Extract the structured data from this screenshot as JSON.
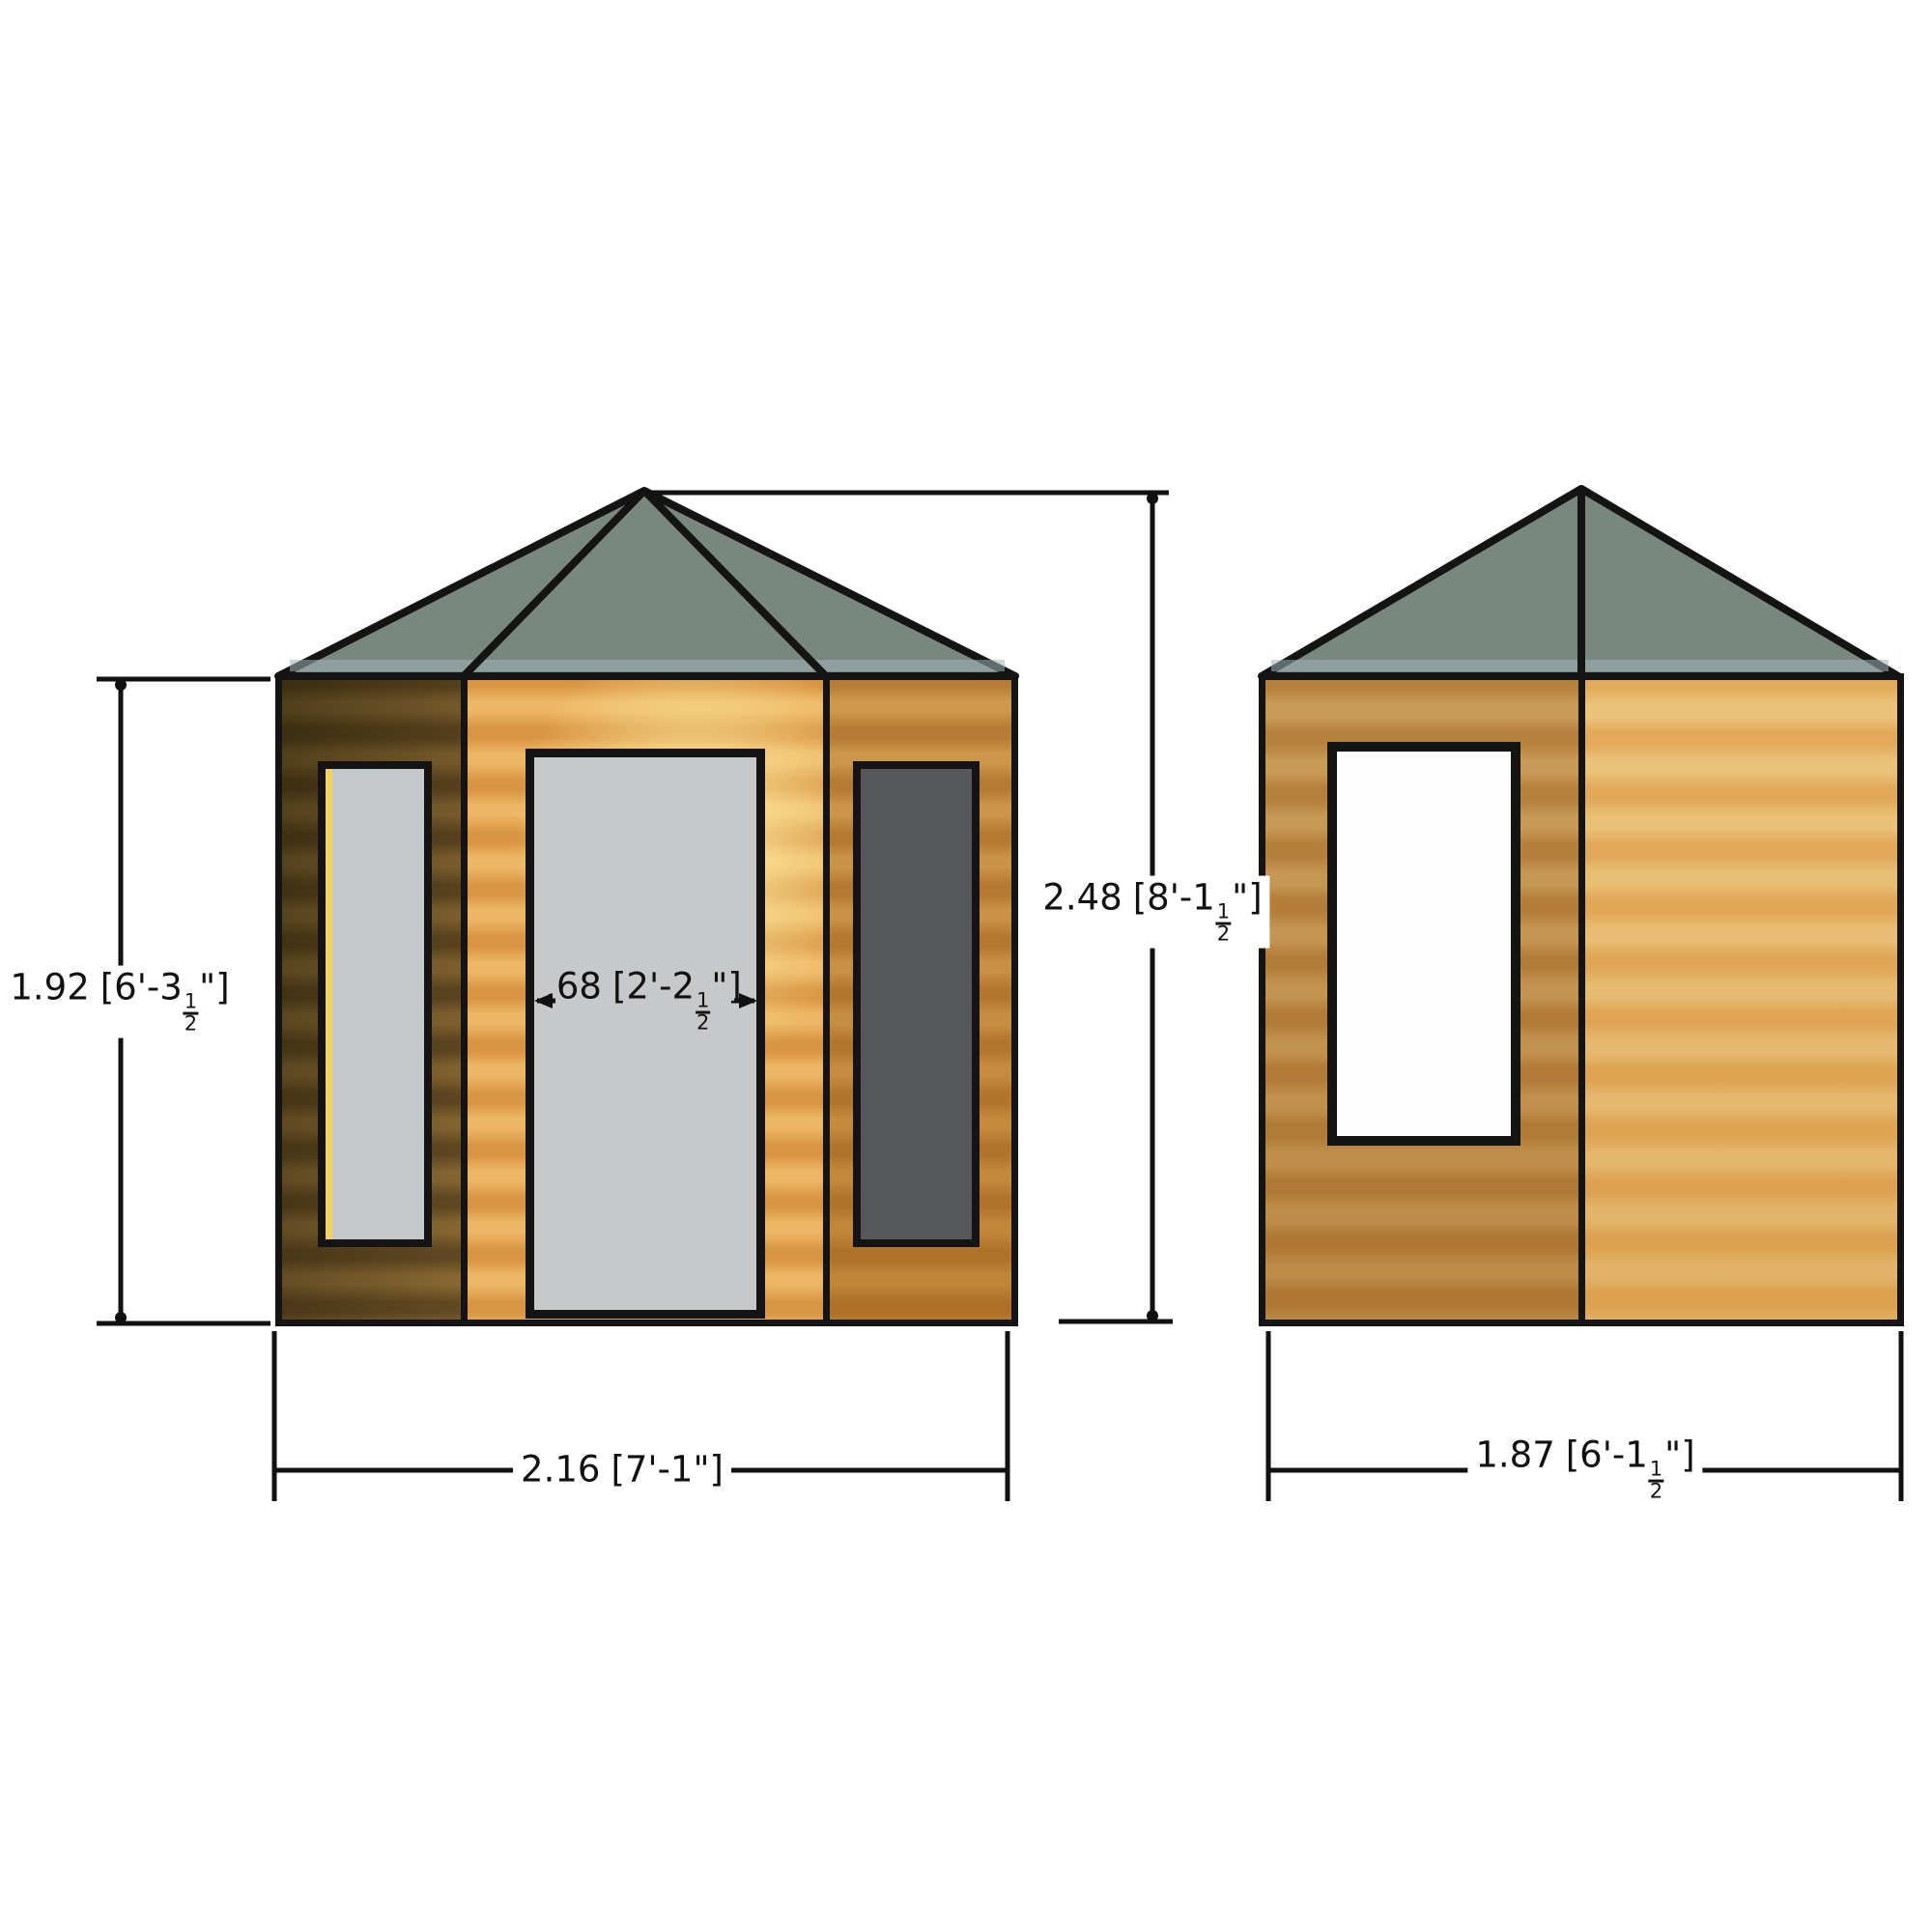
{
  "drawing": {
    "type": "summerhouse elevation drawing",
    "views": [
      "front elevation",
      "side elevation"
    ]
  },
  "dimensions": {
    "eaves_height": {
      "metric": "1.92",
      "imperial_prefix": "[6'-3",
      "fraction_numerator": "1",
      "fraction_denominator": "2",
      "imperial_suffix": "\"]"
    },
    "overall_height": {
      "metric": "2.48",
      "imperial_prefix": "[8'-1",
      "fraction_numerator": "1",
      "fraction_denominator": "2",
      "imperial_suffix": "\"]"
    },
    "door_width": {
      "metric": ".68",
      "imperial_prefix": "[2'-2",
      "fraction_numerator": "1",
      "fraction_denominator": "2",
      "imperial_suffix": "\"]"
    },
    "front_width": {
      "metric": "2.16",
      "imperial_prefix": "[7'-1",
      "fraction_numerator": "",
      "fraction_denominator": "",
      "imperial_suffix": "\"]"
    },
    "side_width": {
      "metric": "1.87",
      "imperial_prefix": "[6'-1",
      "fraction_numerator": "1",
      "fraction_denominator": "2",
      "imperial_suffix": "\"]"
    }
  },
  "colors": {
    "outline": "#141414",
    "roof": "#79887f",
    "roof_eave_highlight": "#9fb3b8",
    "wood_gold": "#ecb766",
    "wood_tan": "#cf9a4e",
    "side_right_wood": "#ecc47c",
    "glass_light": "#c5c8ca",
    "glass_dark": "#55575b",
    "glass_white": "#fdfdfd",
    "door_fill": "#c6c8ca",
    "dim_text": "#111111"
  }
}
